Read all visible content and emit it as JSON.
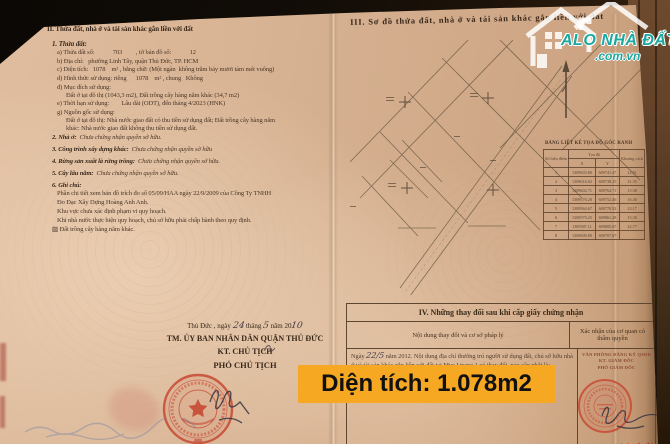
{
  "colors": {
    "banner_bg": "#f7a823",
    "watermark_teal": "#1ba8a0",
    "stamp_red": "#c0392b",
    "paper": "#d5b090"
  },
  "watermark": {
    "brand": "ALO NHÀ ĐẤT",
    "domain": ".com.vn"
  },
  "banner": {
    "text": "Diện tích: 1.078m2"
  },
  "page_left": {
    "section2_title": "II. Thửa đất, nhà ở và tài sản khác gắn liền với đất",
    "item1_title": "1. Thửa đất:",
    "lines": [
      "a) Thửa đất số:            703         , tờ bản đồ số:            12",
      "b) Địa chỉ:   phường Linh Tây, quận Thủ Đức, TP. HCM",
      "c) Diện tích:   1078    m² , bằng chữ: (Một ngàn  không trăm bảy mươi tám mét vuông)",
      "d) Hình thức sử dụng: riêng      1078    m² , chung   Không",
      "đ) Mục đích sử dụng:",
      "Đất ở tại đô thị (1043,3 m2), Đất trồng cây hàng năm khác (34,7 m2)",
      "e) Thời hạn sử dụng:        Lâu dài (ODT), đến tháng 4/2023 (HNK)",
      "g) Nguồn gốc sử dụng:",
      "Đất ở tại đô thị: Nhà nước giao đất có thu tiền sử dụng đất; Đất trồng cây hàng năm",
      "khác: Nhà nước giao đất không thu tiền sử dụng đất."
    ],
    "items": [
      {
        "label": "2. Nhà ở:",
        "value": "  Chưa chứng nhận quyền sở hữu."
      },
      {
        "label": "3. Công trình xây dựng khác:",
        "value": "  Chưa chứng nhận quyền sở hữu"
      },
      {
        "label": "4. Rừng sản xuất là rừng trồng:",
        "value": "  Chưa chứng nhận quyền sở hữu."
      },
      {
        "label": "5. Cây lâu năm:",
        "value": "  Chưa chứng nhận quyền sở hữu."
      }
    ],
    "note_title": "6. Ghi chú:",
    "note_lines": [
      "Phần chi tiết xem bản đồ trích đo số 05/09/HAA ngày 22/9/2009 của Công Ty TNHH",
      "Đo Đạc Xây Dựng Hoàng Anh Anh.",
      "Khu vực chưa xác định phạm vi quy hoạch.",
      "Khi nhà nước thực hiện quy hoạch, chủ sở hữu phải chấp hành theo quy định.",
      "▨ Đất trồng cây hàng năm khác."
    ],
    "sign_block": {
      "date_prefix": "Thủ Đức , ngày ",
      "day": "24",
      "mid1": " tháng ",
      "month": "5",
      "mid2": "  năm 20",
      "year": "10",
      "line1": "TM. ỦY BAN NHÂN DÂN QUẬN THỦ ĐỨC",
      "line2": "KT. CHỦ TỊCH",
      "line3": "PHÓ CHỦ TỊCH"
    }
  },
  "page_right": {
    "section3_title": "III. Sơ đồ thửa đất, nhà ở và tài sản khác gắn liền với đất",
    "coord_table": {
      "title": "BẢNG LIỆT KÊ TỌA ĐỘ GÓC RANH",
      "col_point": "Số hiệu điểm",
      "col_coords": "Tọa độ",
      "col_x": "X",
      "col_y": "Y",
      "col_dist": "Khoảng cách",
      "rows": [
        [
          "1",
          "1309603.80",
          "609741.47",
          "12.51"
        ],
        [
          "2",
          "1309616.02",
          "609738.25",
          "31.35"
        ],
        [
          "3",
          "1309602.71",
          "609764.71",
          "15.38"
        ],
        [
          "4",
          "1309576.20",
          "609752.46",
          "16.46"
        ],
        [
          "5",
          "1309564.67",
          "609770.52",
          "23.17"
        ],
        [
          "6",
          "1309579.25",
          "609861.28",
          "15.30"
        ],
        [
          "7",
          "1309587.11",
          "609805.67",
          "22.77"
        ],
        [
          "8",
          "1309600.80",
          "609707.67",
          ""
        ]
      ]
    },
    "section4": {
      "title": "IV. Những thay đổi sau khi cấp giấy chứng nhận",
      "col1": "Nội dung thay đổi và cơ sở pháp lý",
      "col2": "Xác nhận của cơ quan có thẩm quyền",
      "body_prefix": "Ngày ",
      "body_day": "22/",
      "body_month": "5",
      "body_rest": " năm 2012. Nội dung địa chỉ thường trú người sử dụng đất, chủ sở hữu nhà ở và tài sản khác gắn liền với đất tại Mục I trang 1 có thay đổi, nay cập nhật là:",
      "office_line1": "VĂN PHÒNG ĐĂNG KÝ QSDĐ",
      "office_line2": "KT. GIÁM ĐỐC",
      "office_line3": "PHÓ GIÁM ĐỐC",
      "signer_name": "Đàm Thành Nam"
    }
  }
}
